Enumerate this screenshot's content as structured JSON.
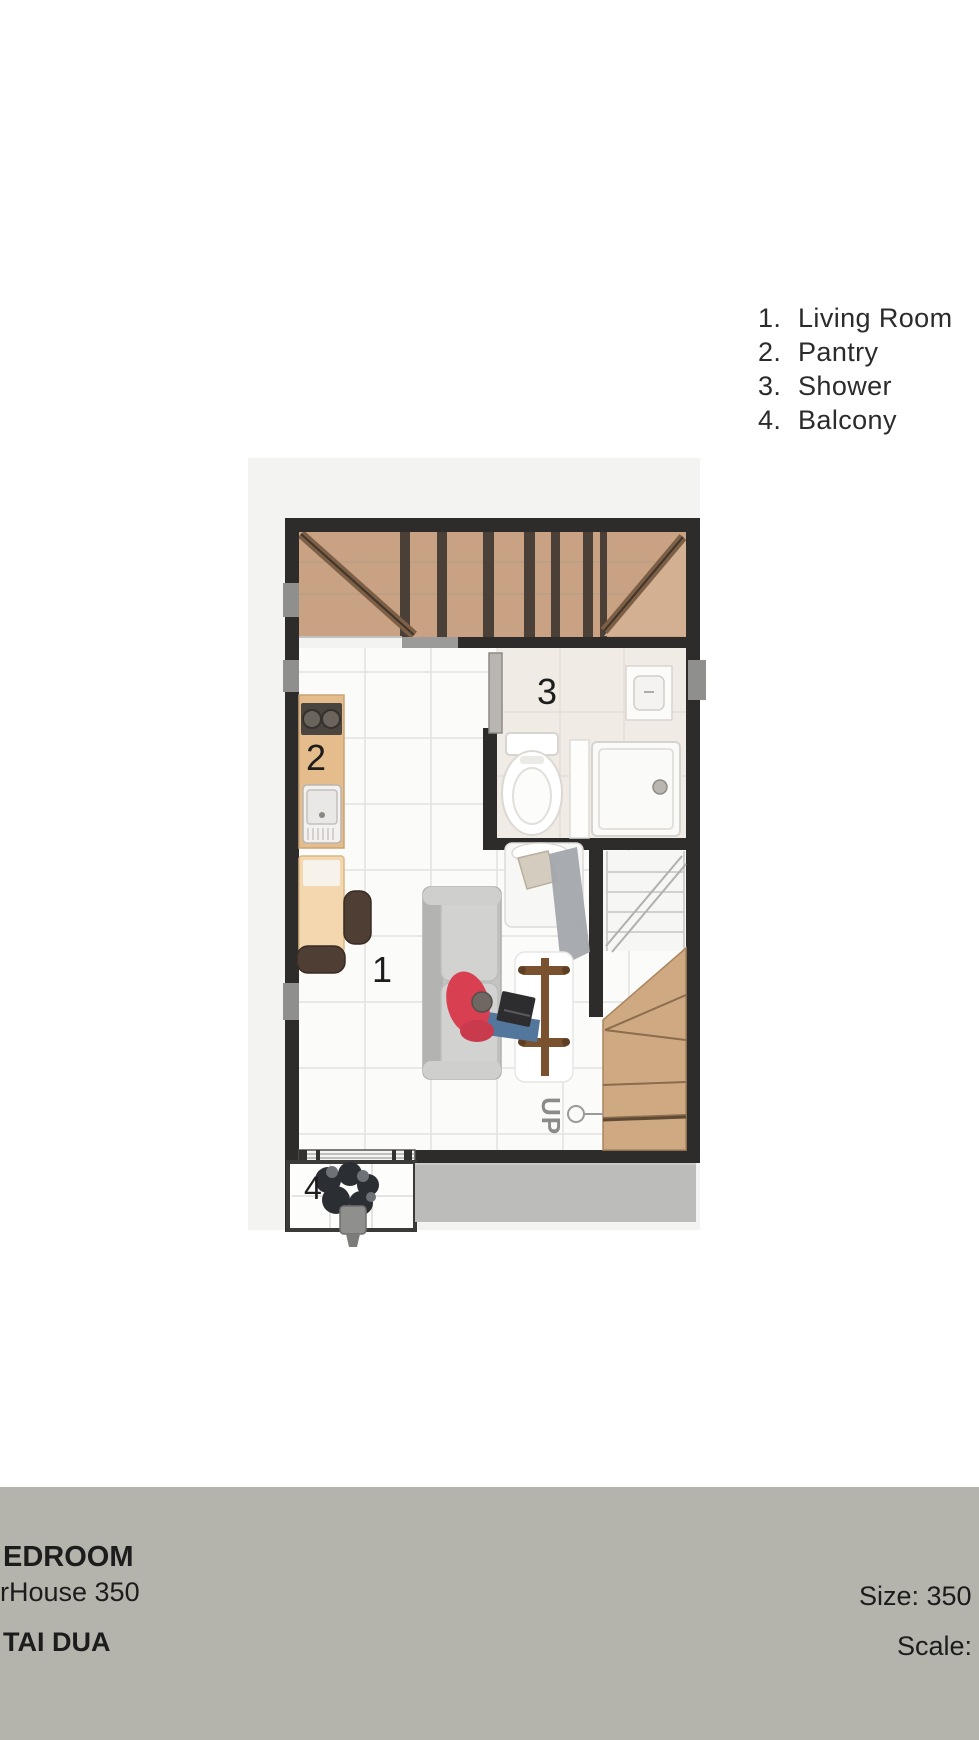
{
  "legend": {
    "items": [
      {
        "number": "1.",
        "label": "Living Room"
      },
      {
        "number": "2.",
        "label": "Pantry"
      },
      {
        "number": "3.",
        "label": "Shower"
      },
      {
        "number": "4.",
        "label": "Balcony"
      }
    ]
  },
  "plan": {
    "labels": {
      "living_room": "1",
      "pantry": "2",
      "shower": "3",
      "balcony": "4",
      "stairs_up": "UP"
    }
  },
  "footer": {
    "title_fragment": "EDROOM",
    "model_fragment": "rHouse 350",
    "floor_fragment": "TAI DUA",
    "size_fragment": "Size: 350 x",
    "scale_fragment": "Scale:"
  },
  "colors": {
    "wall": "#2e2c2a",
    "upper_wood": "#c9a283",
    "stair_wood": "#cfa982",
    "canvas": "#f3f3f1",
    "paving": "#bcbcba",
    "footer_bg": "#b4b3ac",
    "sofa_gray": "#c3c3c2",
    "person_red": "#d84052"
  }
}
